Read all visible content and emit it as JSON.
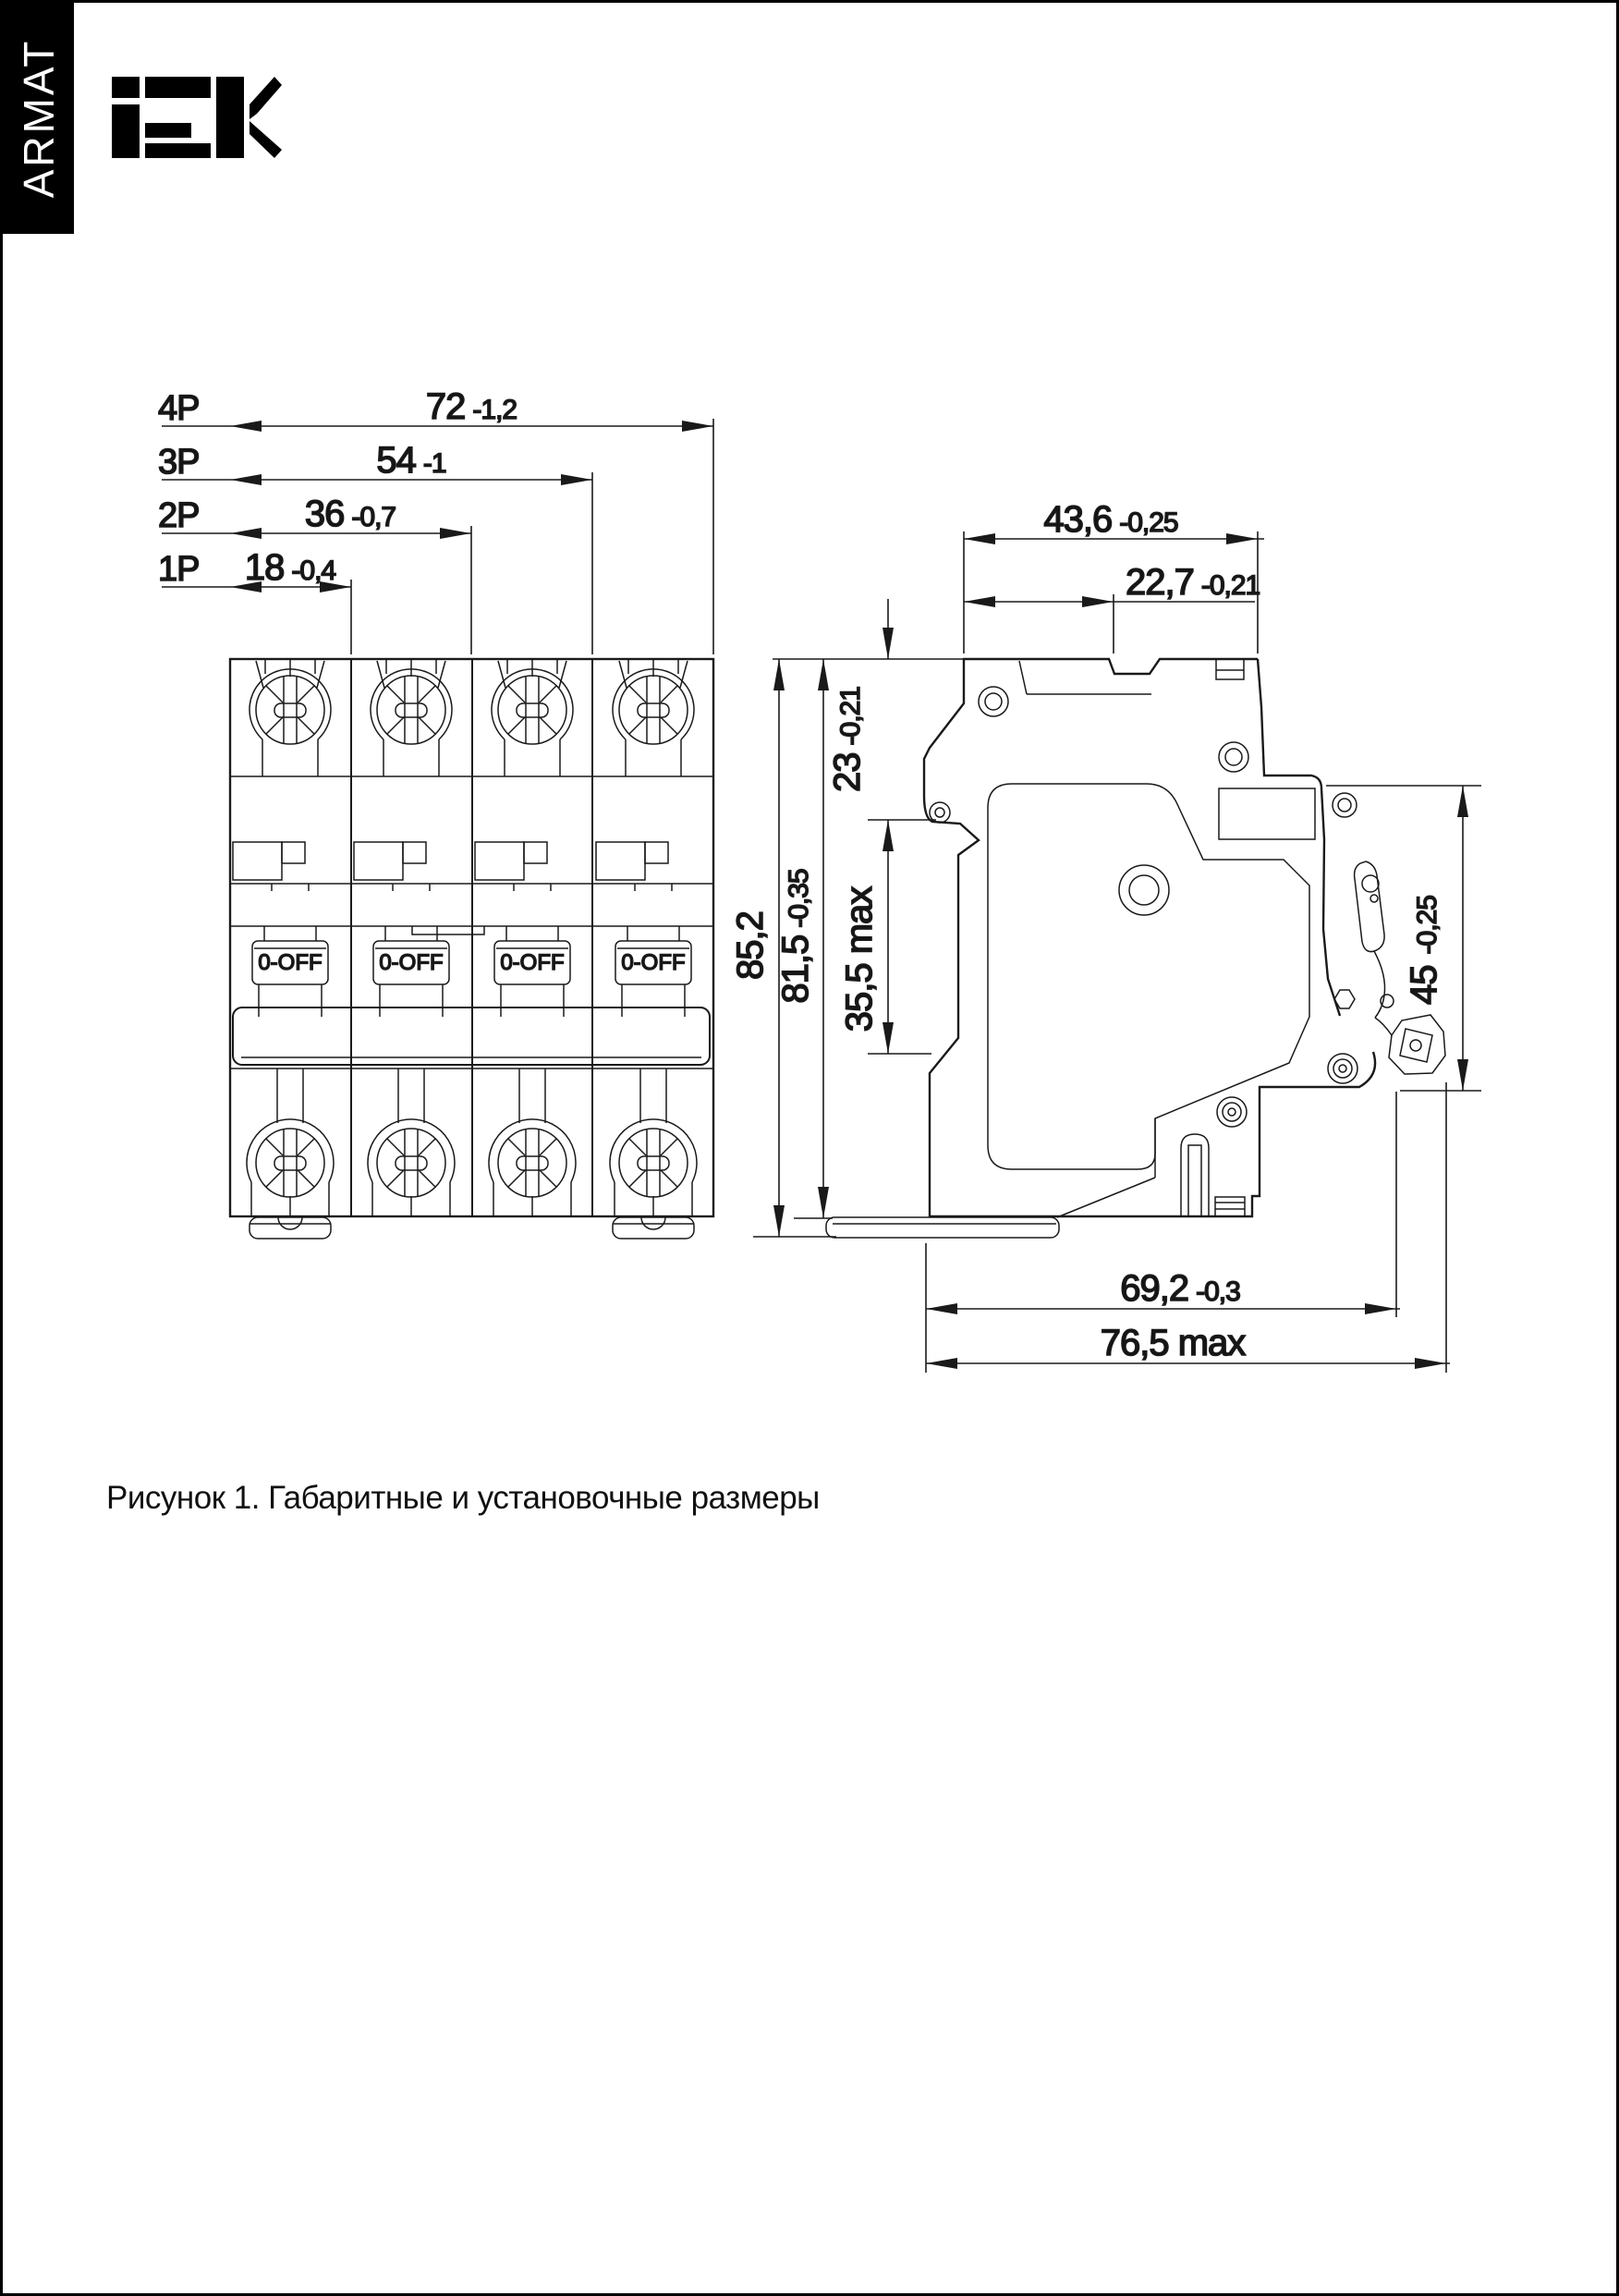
{
  "page": {
    "caption": "Рисунок 1. Габаритные и установочные размеры"
  },
  "brand": {
    "sidebar": "ARMAT",
    "logo": "IEK"
  },
  "front_view": {
    "rows": [
      {
        "label": "4P",
        "value": "72",
        "tol": "-1,2"
      },
      {
        "label": "3P",
        "value": "54",
        "tol": "-1"
      },
      {
        "label": "2P",
        "value": "36",
        "tol": "-0,7"
      },
      {
        "label": "1P",
        "value": "18",
        "tol": "-0,4"
      }
    ],
    "handle": {
      "label": "0-OFF"
    }
  },
  "side_view": {
    "dims": {
      "width_top": {
        "value": "43,6",
        "tol": "-0,25"
      },
      "width_recess": {
        "value": "22,7",
        "tol": "-0,21"
      },
      "height_total": {
        "value": "85,2"
      },
      "height_body": {
        "value": "81,5",
        "tol": "-0,35"
      },
      "top_to_rail": {
        "value": "23",
        "tol": "-0,21"
      },
      "rail_zone": {
        "value": "35,5 max"
      },
      "front_height": {
        "value": "45",
        "tol": "-0,25"
      },
      "depth_body": {
        "value": "69,2",
        "tol": "-0,3"
      },
      "depth_max": {
        "value": "76,5 max"
      }
    }
  }
}
